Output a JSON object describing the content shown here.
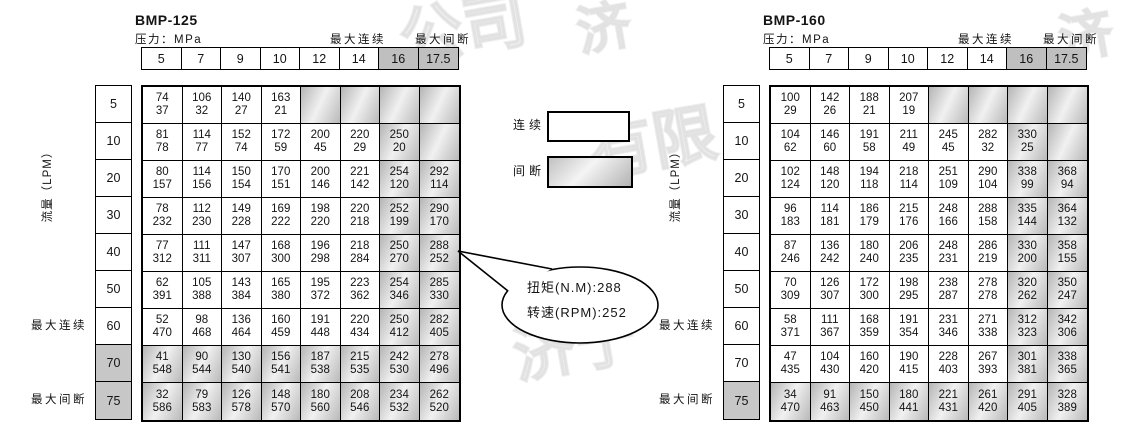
{
  "legend": {
    "continuous_label": "连续",
    "intermittent_label": "间断"
  },
  "callout": {
    "torque_line": "扭矩(N.M):288",
    "speed_line": "转速(RPM):252"
  },
  "watermarks": [
    {
      "text": "公司",
      "x": 398,
      "y": -22,
      "size": 64,
      "rot": -10
    },
    {
      "text": "济",
      "x": 576,
      "y": -16,
      "size": 54,
      "rot": -10
    },
    {
      "text": "液压",
      "x": 148,
      "y": 138,
      "size": 78,
      "rot": -10
    },
    {
      "text": "有限",
      "x": 588,
      "y": 92,
      "size": 64,
      "rot": -10
    },
    {
      "text": "济宁",
      "x": 512,
      "y": 296,
      "size": 62,
      "rot": -10
    },
    {
      "text": "有限",
      "x": 862,
      "y": 142,
      "size": 66,
      "rot": -10
    },
    {
      "text": "济",
      "x": 1058,
      "y": -8,
      "size": 54,
      "rot": -10
    }
  ],
  "tables": [
    {
      "title": "BMP-125",
      "pressure_label": "压力：MPa",
      "max_continuous_header": "最大连续",
      "max_intermittent_header": "最大间断",
      "flow_axis_label": "流量（LPM）",
      "max_continuous_side": "最大连续",
      "max_intermittent_side": "最大间断",
      "pressure_columns": [
        "5",
        "7",
        "9",
        "10",
        "12",
        "14",
        "16",
        "17.5"
      ],
      "flow_rows": [
        "5",
        "10",
        "20",
        "30",
        "40",
        "50",
        "60",
        "70",
        "75"
      ],
      "gray_header_columns": [
        6,
        7
      ],
      "gray_columns": [
        6,
        7
      ],
      "gray_rows": [
        7,
        8
      ],
      "gray_label_rows": [
        7,
        8
      ],
      "cells": [
        [
          [
            74,
            37
          ],
          [
            106,
            32
          ],
          [
            140,
            27
          ],
          [
            163,
            21
          ],
          null,
          null,
          null,
          null
        ],
        [
          [
            81,
            78
          ],
          [
            114,
            77
          ],
          [
            152,
            74
          ],
          [
            172,
            59
          ],
          [
            200,
            45
          ],
          [
            220,
            29
          ],
          [
            250,
            20
          ],
          null
        ],
        [
          [
            80,
            157
          ],
          [
            114,
            156
          ],
          [
            150,
            154
          ],
          [
            170,
            151
          ],
          [
            200,
            146
          ],
          [
            221,
            142
          ],
          [
            254,
            120
          ],
          [
            292,
            114
          ]
        ],
        [
          [
            78,
            232
          ],
          [
            112,
            230
          ],
          [
            149,
            228
          ],
          [
            169,
            222
          ],
          [
            198,
            220
          ],
          [
            220,
            218
          ],
          [
            252,
            199
          ],
          [
            290,
            170
          ]
        ],
        [
          [
            77,
            312
          ],
          [
            111,
            311
          ],
          [
            147,
            307
          ],
          [
            168,
            300
          ],
          [
            196,
            298
          ],
          [
            218,
            284
          ],
          [
            250,
            270
          ],
          [
            288,
            252
          ]
        ],
        [
          [
            62,
            391
          ],
          [
            105,
            388
          ],
          [
            143,
            384
          ],
          [
            165,
            380
          ],
          [
            195,
            372
          ],
          [
            223,
            362
          ],
          [
            254,
            346
          ],
          [
            285,
            330
          ]
        ],
        [
          [
            52,
            470
          ],
          [
            98,
            468
          ],
          [
            136,
            464
          ],
          [
            160,
            459
          ],
          [
            191,
            448
          ],
          [
            220,
            434
          ],
          [
            250,
            412
          ],
          [
            282,
            405
          ]
        ],
        [
          [
            41,
            548
          ],
          [
            90,
            544
          ],
          [
            130,
            540
          ],
          [
            156,
            541
          ],
          [
            187,
            538
          ],
          [
            215,
            535
          ],
          [
            242,
            530
          ],
          [
            278,
            496
          ]
        ],
        [
          [
            32,
            586
          ],
          [
            79,
            583
          ],
          [
            126,
            578
          ],
          [
            148,
            570
          ],
          [
            180,
            560
          ],
          [
            208,
            546
          ],
          [
            234,
            532
          ],
          [
            262,
            520
          ]
        ]
      ]
    },
    {
      "title": "BMP-160",
      "pressure_label": "压力：MPa",
      "max_continuous_header": "最大连续",
      "max_intermittent_header": "最大间断",
      "flow_axis_label": "流量（LPM）",
      "max_continuous_side": "最大连续",
      "max_intermittent_side": "最大间断",
      "pressure_columns": [
        "5",
        "7",
        "9",
        "10",
        "12",
        "14",
        "16",
        "17.5"
      ],
      "flow_rows": [
        "5",
        "10",
        "20",
        "30",
        "40",
        "50",
        "60",
        "70",
        "75"
      ],
      "gray_header_columns": [
        6,
        7
      ],
      "gray_columns": [
        6,
        7
      ],
      "gray_rows": [
        8
      ],
      "gray_label_rows": [
        8
      ],
      "cells": [
        [
          [
            100,
            29
          ],
          [
            142,
            26
          ],
          [
            188,
            21
          ],
          [
            207,
            19
          ],
          null,
          null,
          null,
          null
        ],
        [
          [
            104,
            62
          ],
          [
            146,
            60
          ],
          [
            191,
            58
          ],
          [
            211,
            49
          ],
          [
            245,
            45
          ],
          [
            282,
            32
          ],
          [
            330,
            25
          ],
          null
        ],
        [
          [
            102,
            124
          ],
          [
            148,
            120
          ],
          [
            194,
            118
          ],
          [
            218,
            114
          ],
          [
            251,
            109
          ],
          [
            290,
            104
          ],
          [
            338,
            99
          ],
          [
            368,
            94
          ]
        ],
        [
          [
            96,
            183
          ],
          [
            114,
            181
          ],
          [
            186,
            179
          ],
          [
            215,
            176
          ],
          [
            248,
            166
          ],
          [
            288,
            158
          ],
          [
            335,
            144
          ],
          [
            364,
            132
          ]
        ],
        [
          [
            87,
            246
          ],
          [
            136,
            242
          ],
          [
            180,
            240
          ],
          [
            206,
            235
          ],
          [
            248,
            231
          ],
          [
            286,
            219
          ],
          [
            330,
            200
          ],
          [
            358,
            155
          ]
        ],
        [
          [
            70,
            309
          ],
          [
            126,
            307
          ],
          [
            172,
            300
          ],
          [
            198,
            295
          ],
          [
            238,
            287
          ],
          [
            278,
            278
          ],
          [
            320,
            262
          ],
          [
            350,
            247
          ]
        ],
        [
          [
            58,
            371
          ],
          [
            111,
            367
          ],
          [
            168,
            359
          ],
          [
            191,
            354
          ],
          [
            231,
            346
          ],
          [
            271,
            338
          ],
          [
            312,
            323
          ],
          [
            342,
            306
          ]
        ],
        [
          [
            47,
            435
          ],
          [
            104,
            430
          ],
          [
            160,
            420
          ],
          [
            190,
            415
          ],
          [
            228,
            403
          ],
          [
            267,
            393
          ],
          [
            301,
            381
          ],
          [
            338,
            365
          ]
        ],
        [
          [
            34,
            470
          ],
          [
            91,
            463
          ],
          [
            150,
            450
          ],
          [
            180,
            441
          ],
          [
            221,
            431
          ],
          [
            261,
            420
          ],
          [
            291,
            405
          ],
          [
            328,
            389
          ]
        ]
      ]
    }
  ]
}
